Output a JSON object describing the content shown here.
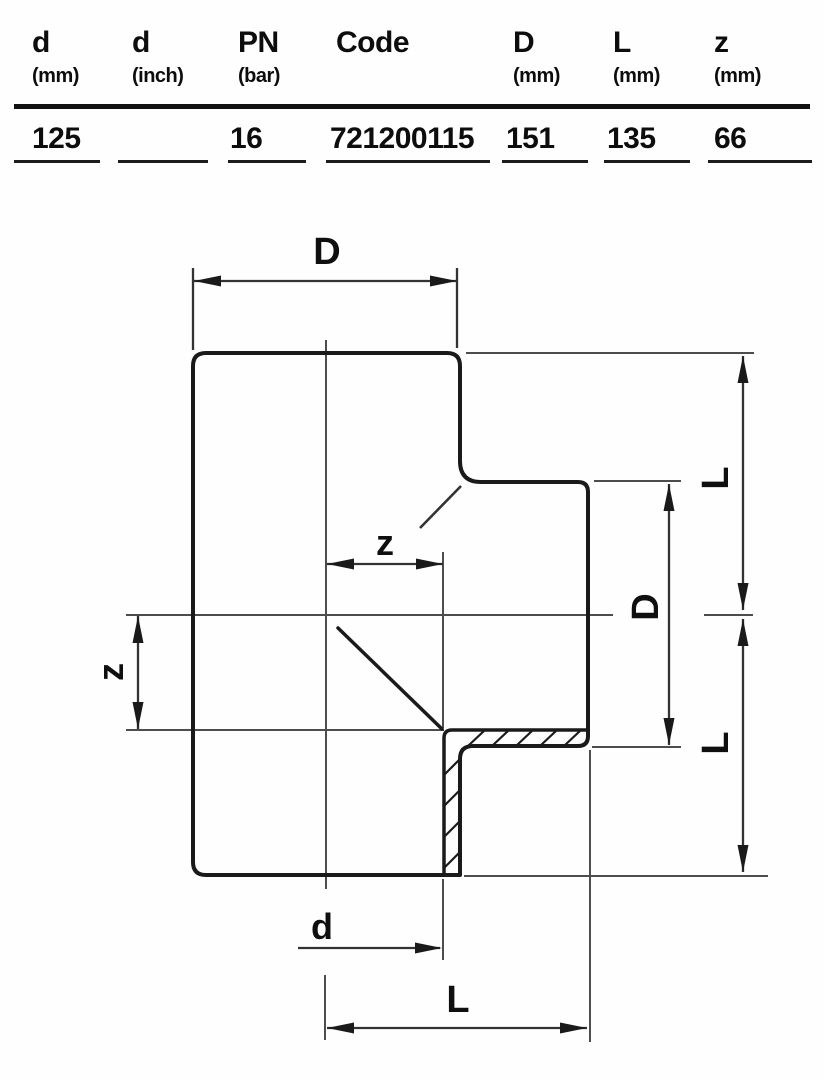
{
  "table": {
    "columns": [
      {
        "label": "d",
        "unit": "(mm)",
        "value": "125"
      },
      {
        "label": "d",
        "unit": "(inch)",
        "value": ""
      },
      {
        "label": "PN",
        "unit": "(bar)",
        "value": "16"
      },
      {
        "label": "Code",
        "unit": "",
        "value": "721200115"
      },
      {
        "label": "D",
        "unit": "(mm)",
        "value": "151"
      },
      {
        "label": "L",
        "unit": "(mm)",
        "value": "135"
      },
      {
        "label": "z",
        "unit": "(mm)",
        "value": "66"
      }
    ]
  },
  "drawing": {
    "labels": {
      "top_width": "D",
      "branch_offset": "z",
      "left_offset": "z",
      "branch_outer_diameter": "D",
      "upper_length": "L",
      "lower_length": "L",
      "bore_diameter": "d",
      "bottom_length": "L"
    },
    "colors": {
      "outline": "#1a1a1a",
      "dimension_line": "#333333",
      "center_line": "#4d4d4d",
      "background": "#fefefe"
    }
  }
}
